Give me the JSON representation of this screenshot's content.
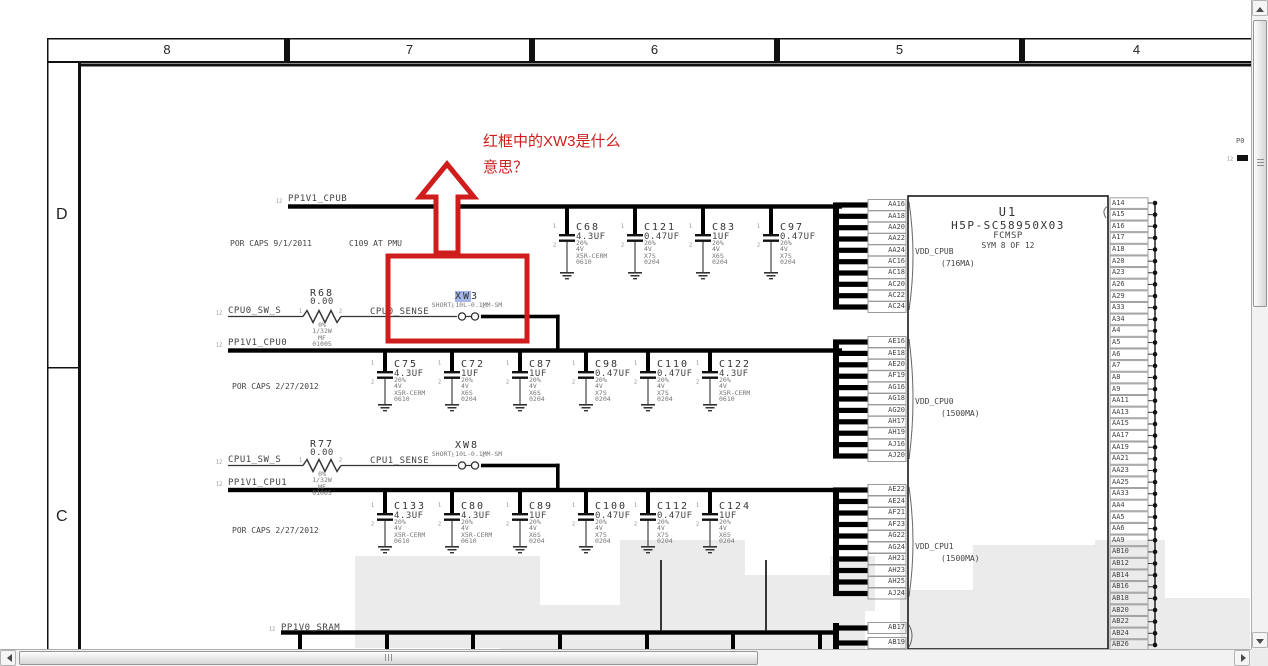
{
  "header": {
    "columns": [
      "8",
      "7",
      "6",
      "5",
      "4"
    ],
    "row_labels": [
      "D",
      "C"
    ]
  },
  "annotation": {
    "line1": "红框中的XW3是什么",
    "line2": "意思？"
  },
  "sections": {
    "row1": {
      "ref": "12",
      "net": "PP1V1_CPUB",
      "note_left": "POR CAPS 9/1/2011",
      "note_right": "C109 AT PMU",
      "caps": [
        {
          "ref": "C68",
          "value": "4.3UF",
          "specs": [
            "20%",
            "4V",
            "X5R-CERM",
            "0610"
          ]
        },
        {
          "ref": "C121",
          "value": "0.47UF",
          "specs": [
            "20%",
            "4V",
            "X7S",
            "0204"
          ]
        },
        {
          "ref": "C83",
          "value": "1UF",
          "specs": [
            "20%",
            "4V",
            "X6S",
            "0204"
          ]
        },
        {
          "ref": "C97",
          "value": "0.47UF",
          "specs": [
            "20%",
            "4V",
            "X7S",
            "0204"
          ]
        }
      ],
      "rail": {
        "name": "VDD_CPUB",
        "current": "(716MA)",
        "pins": [
          "AA16",
          "AA18",
          "AA20",
          "AA22",
          "AA24",
          "AC16",
          "AC18",
          "AC20",
          "AC22",
          "AC24"
        ]
      }
    },
    "row2": {
      "ref": "12",
      "net": "PP1V1_CPU0",
      "note_left": "POR CAPS 2/27/2012",
      "caps": [
        {
          "ref": "C75",
          "value": "4.3UF",
          "specs": [
            "20%",
            "4V",
            "X5R-CERM",
            "0610"
          ]
        },
        {
          "ref": "C72",
          "value": "1UF",
          "specs": [
            "20%",
            "4V",
            "X6S",
            "0204"
          ]
        },
        {
          "ref": "C87",
          "value": "1UF",
          "specs": [
            "20%",
            "4V",
            "X6S",
            "0204"
          ]
        },
        {
          "ref": "C98",
          "value": "0.47UF",
          "specs": [
            "20%",
            "4V",
            "X7S",
            "0204"
          ]
        },
        {
          "ref": "C110",
          "value": "0.47UF",
          "specs": [
            "20%",
            "4V",
            "X7S",
            "0204"
          ]
        },
        {
          "ref": "C122",
          "value": "4.3UF",
          "specs": [
            "20%",
            "4V",
            "X5R-CERM",
            "0610"
          ]
        }
      ],
      "rail": {
        "name": "VDD_CPU0",
        "current": "(1500MA)",
        "pins": [
          "AE16",
          "AE18",
          "AE20",
          "AF19",
          "AG16",
          "AG18",
          "AG20",
          "AH17",
          "AH19",
          "AJ16",
          "AJ20"
        ]
      }
    },
    "row3": {
      "ref": "12",
      "net": "PP1V1_CPU1",
      "note_left": "POR CAPS 2/27/2012",
      "caps": [
        {
          "ref": "C133",
          "value": "4.3UF",
          "specs": [
            "20%",
            "4V",
            "X5R-CERM",
            "0610"
          ]
        },
        {
          "ref": "C80",
          "value": "4.3UF",
          "specs": [
            "20%",
            "4V",
            "X5R-CERM",
            "0610"
          ]
        },
        {
          "ref": "C89",
          "value": "1UF",
          "specs": [
            "20%",
            "4V",
            "X6S",
            "0204"
          ]
        },
        {
          "ref": "C100",
          "value": "0.47UF",
          "specs": [
            "20%",
            "4V",
            "X7S",
            "0204"
          ]
        },
        {
          "ref": "C112",
          "value": "0.47UF",
          "specs": [
            "20%",
            "4V",
            "X7S",
            "0204"
          ]
        },
        {
          "ref": "C124",
          "value": "1UF",
          "specs": [
            "20%",
            "4V",
            "X6S",
            "0204"
          ]
        }
      ],
      "rail": {
        "name": "VDD_CPU1",
        "current": "(1500MA)",
        "pins": [
          "AE22",
          "AE24",
          "AF21",
          "AF23",
          "AG22",
          "AG24",
          "AH21",
          "AH23",
          "AH25",
          "AJ24"
        ]
      }
    },
    "bottom": {
      "ref": "12",
      "net": "PP1V0_SRAM",
      "pins": [
        "AB17",
        "AB19"
      ]
    }
  },
  "sense_paths": [
    {
      "in_ref": "12",
      "in_net": "CPU0_SW_S",
      "resistor": {
        "ref": "R68",
        "value": "0.00",
        "specs": [
          "0%",
          "1/32W",
          "MF",
          "01005"
        ],
        "pins": [
          "1",
          "2"
        ]
      },
      "out_net": "CPU0_SENSE",
      "jumper": {
        "ref": "XW3",
        "spec": "SHORT-10L-0.1MM-SM",
        "pins": [
          "1",
          "2"
        ],
        "selected": true
      }
    },
    {
      "in_ref": "12",
      "in_net": "CPU1_SW_S",
      "resistor": {
        "ref": "R77",
        "value": "0.00",
        "specs": [
          "0%",
          "1/32W",
          "MF",
          "01005"
        ],
        "pins": [
          "1",
          "2"
        ]
      },
      "out_net": "CPU1_SENSE",
      "jumper": {
        "ref": "XW8",
        "spec": "SHORT-10L-0.1MM-SM",
        "pins": [
          "1",
          "2"
        ],
        "selected": false
      }
    }
  ],
  "chip": {
    "ref": "U1",
    "part": "H5P-SC58950X03",
    "package": "FCMSP",
    "symbol_note": "SYM 8 OF 12",
    "right_pins": [
      "A14",
      "A15",
      "A16",
      "A17",
      "A18",
      "A20",
      "A23",
      "A26",
      "A29",
      "A33",
      "A34",
      "A4",
      "A5",
      "A6",
      "A7",
      "A8",
      "A9",
      "AA11",
      "AA13",
      "AA15",
      "AA17",
      "AA19",
      "AA21",
      "AA23",
      "AA25",
      "AA33",
      "AA4",
      "AA5",
      "AA6",
      "AA9",
      "AB10",
      "AB12",
      "AB14",
      "AB16",
      "AB18",
      "AB20",
      "AB22",
      "AB24",
      "AB26"
    ]
  },
  "cap_pin_numbers": [
    "1",
    "2"
  ],
  "fragments": {
    "top_right_text": "P0",
    "top_right_ref": "12"
  },
  "colors": {
    "annotation_red": "#cf1d1d",
    "selection_blue": "#a3b8e8",
    "watermark_gray": "#ebebeb",
    "bus_black": "#000000",
    "wire_gray": "#555555"
  }
}
